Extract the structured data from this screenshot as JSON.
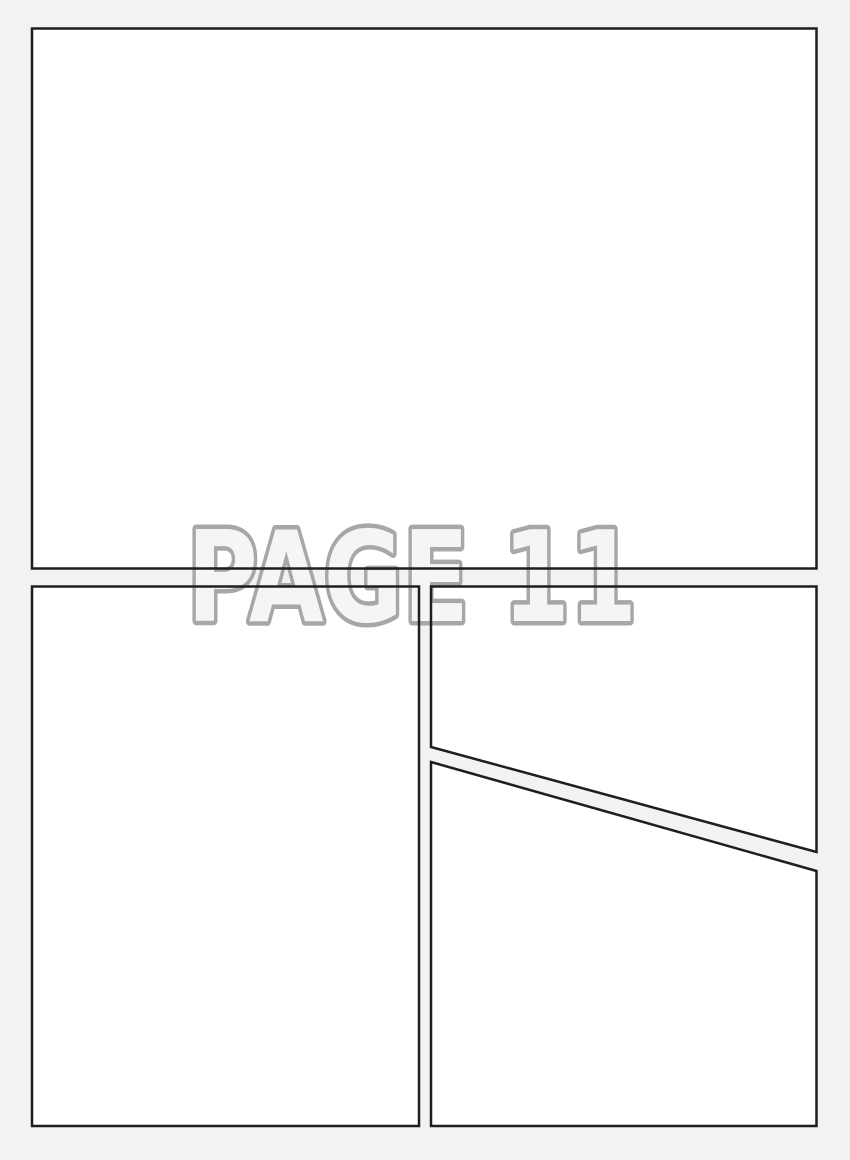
{
  "page": {
    "watermark_text": "PAGE 11"
  },
  "colors": {
    "background": "#f2f2f2",
    "panel_fill": "#ffffff",
    "panel_border": "#1e1e1e",
    "watermark_fill": "#f5f5f5",
    "watermark_stroke": "#a7a7a7"
  }
}
